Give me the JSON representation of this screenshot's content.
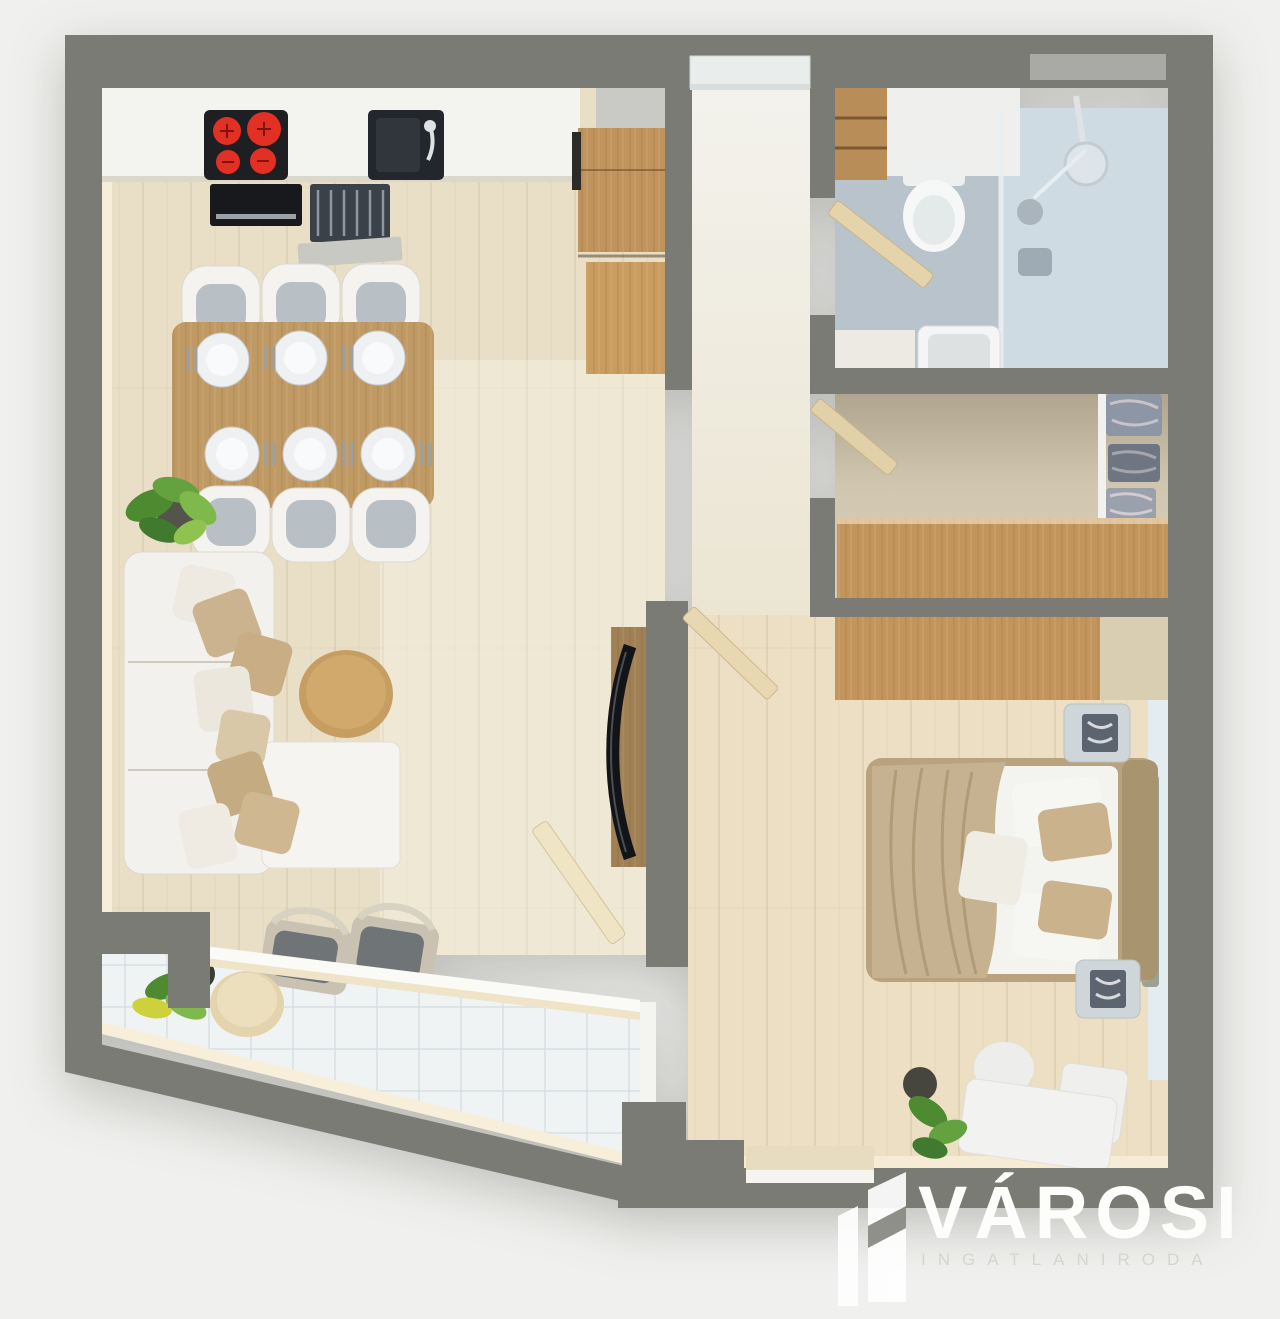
{
  "page": {
    "background_color": "#f0f0ee",
    "description": "Top-down 3D rendered floor plan of a one-bedroom apartment with balcony"
  },
  "branding": {
    "logo_title": "VÁROSI",
    "logo_subtitle": "INGATLANIRODA",
    "logo_icon": "building-logo-icon",
    "title_color": "#fdfdfc",
    "subtitle_color": "#d5d5d0"
  },
  "palette": {
    "wall_gray": "#7b7b75",
    "wall_window_strip": "#a9a9a5",
    "wood_floor_living": "#e9dfc6",
    "wood_floor_bedroom": "#ecdfc4",
    "wood_floor_closet": "#d8cdb6",
    "bathroom_floor": "#b8c3cb",
    "shower_floor": "#cfdbe3",
    "balcony_tile": "#eff3f4",
    "cabinet_wood": "#c2955c",
    "table_wood": "#bf9a64",
    "door_leaf_wood": "#e5d4ab",
    "counter_white": "#f3f3f0",
    "appliance_black": "#1d1f22",
    "burner_red": "#e23025",
    "sofa_white": "#f2f1ed",
    "pillow_tan": "#cbb390",
    "bed_blanket_tan": "#c6b291",
    "nightstand_blue_gray": "#cfd6da",
    "plant_green": "#5f9c3c",
    "window_glass": "#e3ecf1"
  },
  "floor_plan": {
    "view": "top-down-3d-render",
    "rooms": [
      {
        "name": "kitchen",
        "furniture": [
          "kitchen-counter",
          "cooktop-4-burners",
          "oven",
          "kitchen-sink",
          "dishwasher",
          "tall-cabinet-column"
        ]
      },
      {
        "name": "dining-area",
        "furniture": [
          "dining-table",
          "dining-chair x6",
          "place-setting x6",
          "potted-plant"
        ]
      },
      {
        "name": "living-room",
        "furniture": [
          "sofa",
          "throw-pillow x8",
          "ottoman",
          "round-coffee-table",
          "tv-panel",
          "curved-tv"
        ]
      },
      {
        "name": "entry-hall",
        "furniture": [
          "entry-door"
        ]
      },
      {
        "name": "bathroom",
        "furniture": [
          "wooden-shelf",
          "vanity-counter",
          "toilet",
          "shower",
          "shower-head",
          "washbasin",
          "basin-cabinet",
          "bathroom-door"
        ]
      },
      {
        "name": "closet-hall",
        "furniture": [
          "wardrobe",
          "clothes-shelves",
          "closet-door"
        ]
      },
      {
        "name": "bedroom",
        "furniture": [
          "dresser",
          "double-bed",
          "blanket",
          "pillow x5",
          "nightstand x2",
          "bench-set",
          "potted-plant",
          "bottom-window",
          "side-window",
          "bedroom-door"
        ]
      },
      {
        "name": "balcony",
        "furniture": [
          "lounge-chair x2",
          "round-side-table",
          "potted-plant",
          "balcony-door",
          "glass-front"
        ]
      }
    ]
  }
}
